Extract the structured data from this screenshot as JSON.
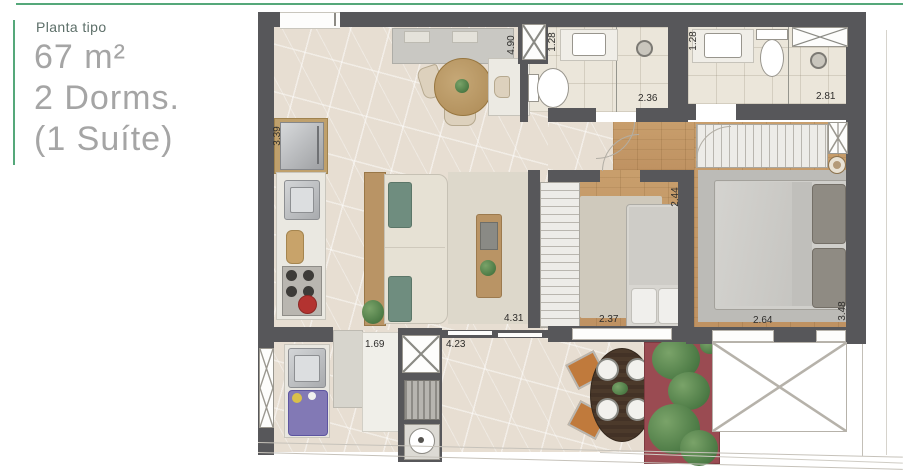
{
  "panel": {
    "subtitle": "Planta tipo",
    "area": "67 m²",
    "dorms": "2 Dorms.",
    "suite": "(1 Suíte)"
  },
  "measurements": {
    "living_top": "4.90",
    "bath1_door": "1.28",
    "bath1_width": "2.36",
    "bath2_door": "1.28",
    "bath2_width": "2.81",
    "kitchen_side": "3.39",
    "bed2_door": "2.44",
    "living_bottom": "4.31",
    "bed2_width": "2.37",
    "suite_width": "2.64",
    "suite_side": "3.48",
    "service_width": "1.69",
    "balcony_width": "4.23"
  },
  "colors": {
    "accent_green": "#55a87a",
    "wall_gray": "#57575a",
    "stone_floor": "#e7ded2",
    "wood_floor": "#c49a68",
    "tile_floor": "#ebe6da",
    "rug_gray": "#c2c1bd",
    "sofa_pillow_green": "#6f8d7f",
    "planter_red": "#9a4b52",
    "plant_green": "#578550",
    "washer_purple": "#8279b5",
    "kettle_red": "#b33330"
  }
}
